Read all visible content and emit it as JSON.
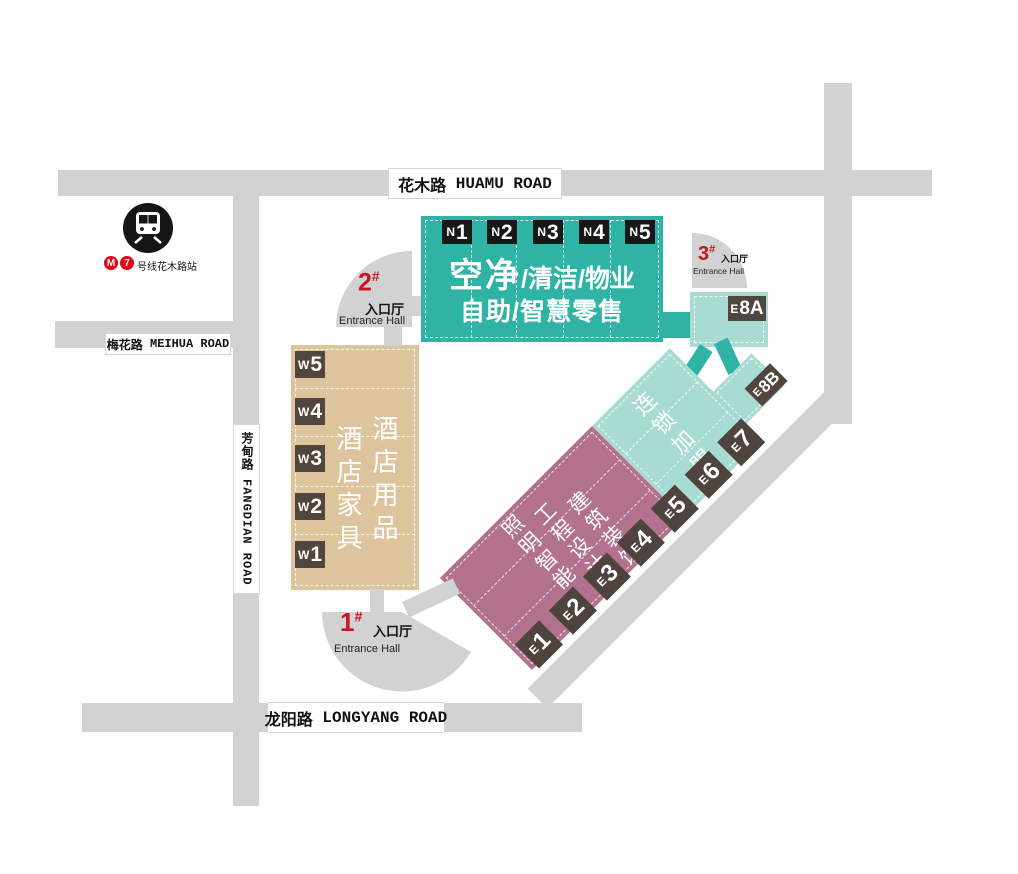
{
  "roads": {
    "huamu": {
      "zh": "花木路",
      "en": "HUAMU ROAD"
    },
    "meihua": {
      "zh": "梅花路",
      "en": "MEIHUA ROAD"
    },
    "fangdian": {
      "zh": "芳甸路",
      "en": "FANGDIAN ROAD"
    },
    "longyang": {
      "zh": "龙阳路",
      "en": "LONGYANG ROAD"
    }
  },
  "metro": {
    "line_num": "7",
    "station_suffix": "号线花木路站"
  },
  "entrances": {
    "no1": {
      "num": "1",
      "hash": "#",
      "zh": "入口厅",
      "en": "Entrance Hall"
    },
    "no2": {
      "num": "2",
      "hash": "#",
      "zh": "入口厅",
      "en": "Entrance Hall"
    },
    "no3": {
      "num": "3",
      "hash": "#",
      "zh": "入口厅",
      "en": "Entrance Hall"
    }
  },
  "halls": {
    "north": {
      "badges": [
        {
          "p": "N",
          "n": "1"
        },
        {
          "p": "N",
          "n": "2"
        },
        {
          "p": "N",
          "n": "3"
        },
        {
          "p": "N",
          "n": "4"
        },
        {
          "p": "N",
          "n": "5"
        }
      ],
      "title_strong": "空净",
      "title_rest": "/清洁/物业",
      "subtitle": "自助/智慧零售"
    },
    "west": {
      "badges": [
        {
          "p": "W",
          "n": "5"
        },
        {
          "p": "W",
          "n": "4"
        },
        {
          "p": "W",
          "n": "3"
        },
        {
          "p": "W",
          "n": "2"
        },
        {
          "p": "W",
          "n": "1"
        }
      ],
      "col_right": "酒店用品",
      "col_left": "酒店家具"
    },
    "east": {
      "badges": [
        {
          "p": "E",
          "n": "1"
        },
        {
          "p": "E",
          "n": "2"
        },
        {
          "p": "E",
          "n": "3"
        },
        {
          "p": "E",
          "n": "4"
        },
        {
          "p": "E",
          "n": "5"
        },
        {
          "p": "E",
          "n": "6"
        },
        {
          "p": "E",
          "n": "7"
        }
      ],
      "pink_cols": [
        "建筑装饰",
        "工程设计",
        "照明智能"
      ],
      "teal_label": "连锁加盟"
    },
    "e8a": {
      "badge": {
        "p": "E",
        "n": "8A"
      }
    },
    "e8b": {
      "badge": {
        "p": "E",
        "n": "8B"
      }
    }
  },
  "colors": {
    "teal": "#2fb3a4",
    "teal_light": "#a8dbd2",
    "tan": "#ddc49d",
    "pink": "#b2718c",
    "badge_brown": "#51463e",
    "badge_black": "#181818",
    "road_gray": "#d2d2d2",
    "entrance_red": "#cd1225",
    "metro_red": "#e60012"
  }
}
